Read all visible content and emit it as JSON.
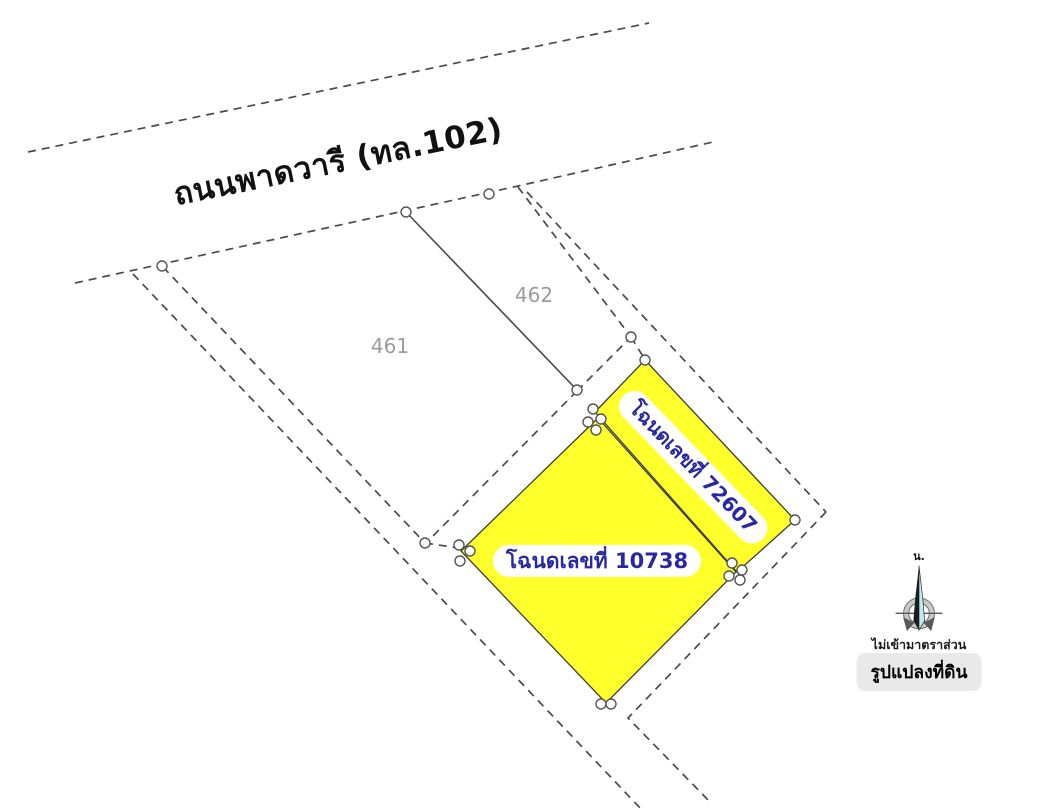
{
  "road": {
    "label": "ถนนพาดวารี (ทล.102)"
  },
  "plots": {
    "plot_461": {
      "label": "461"
    },
    "plot_462": {
      "label": "462"
    },
    "deed_72607": {
      "label": "โฉนดเลขที่ 72607"
    },
    "deed_10738": {
      "label": "โฉนดเลขที่ 10738"
    }
  },
  "compass": {
    "north_label": "น."
  },
  "notes": {
    "not_to_scale": "ไม่เข้ามาตราส่วน",
    "figure_caption": "รูปแปลงที่ดิน"
  },
  "colors": {
    "parcel_fill": "#FFFF2B",
    "parcel_border": "#3d3d3d",
    "deed_text": "#2828A0",
    "boundary_line": "#4A4A4A",
    "plot_number_text": "#9B9B9B",
    "caption_bg": "#E9E9E9",
    "compass_accent": "#BFE9F4"
  }
}
